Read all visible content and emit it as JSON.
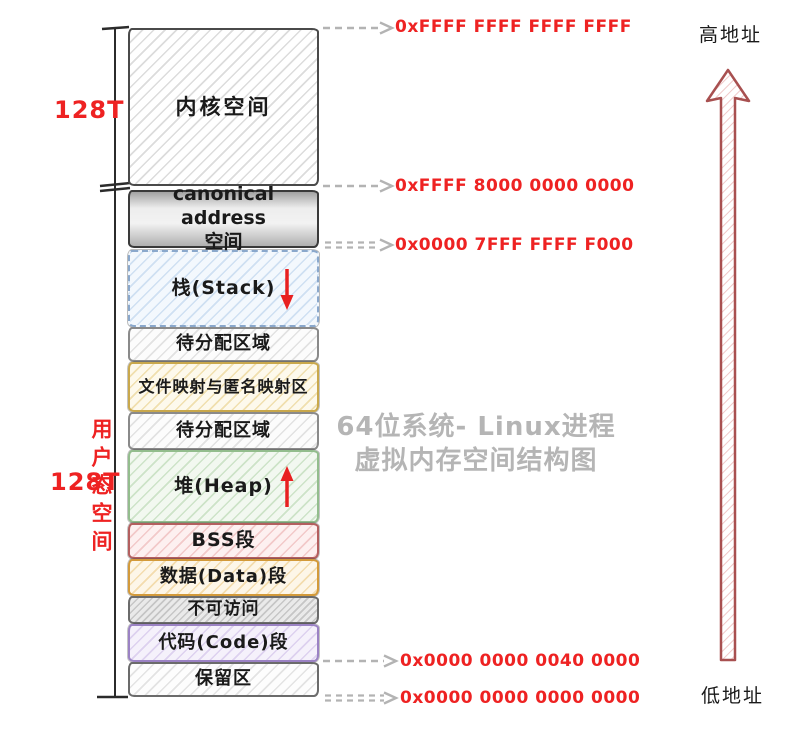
{
  "diagram_title": {
    "line1": "64位系统- Linux进程",
    "line2": "虚拟内存空间结构图"
  },
  "left_labels": {
    "kernel_size": "128T",
    "user_size": "128T",
    "user_space": "用户态空间"
  },
  "axis_labels": {
    "high": "高地址",
    "low": "低地址"
  },
  "addresses": {
    "top": "0xFFFF FFFF FFFF FFFF",
    "kernel_bottom": "0xFFFF 8000 0000 0000",
    "stack_top": "0x0000 7FFF FFFF F000",
    "code_start": "0x0000 0000 0040 0000",
    "zero": "0x0000 0000 0000 0000"
  },
  "colors": {
    "address_text": "#ee2222",
    "size_label_text": "#ee2222",
    "title_text": "#b5b5b5",
    "dashed_arrow": "#b3b3b3",
    "growth_arrow": "#e82020",
    "axis_arrow_stroke": "#a85050",
    "axis_arrow_hatch": "#eec2c2",
    "bracket_line": "#2b2b2b"
  },
  "segments": [
    {
      "name": "kernel-space",
      "label": "内核空间",
      "fill": "#ffffff",
      "hatch": "#dcdcdc",
      "border": "#4a4a4a"
    },
    {
      "name": "canonical-address",
      "label": "canonical address 空间",
      "line1": "canonical address",
      "line2": "空间",
      "fill": "#d9d9d9",
      "hatch": "transparent",
      "border": "#3a3a3a"
    },
    {
      "name": "stack",
      "label": "栈(Stack)",
      "growth": "down",
      "fill": "#f3f8fd",
      "hatch": "#cfe0f2",
      "border": "#8aa8cc"
    },
    {
      "name": "unallocated-upper",
      "label": "待分配区域",
      "fill": "#fcfcfc",
      "hatch": "#e2e2e2",
      "border": "#8a8a8a"
    },
    {
      "name": "file-mapping",
      "label": "文件映射与匿名映射区",
      "fill": "#fdf9ec",
      "hatch": "#f0dfae",
      "border": "#c9a84c"
    },
    {
      "name": "unallocated-lower",
      "label": "待分配区域",
      "fill": "#fcfcfc",
      "hatch": "#e2e2e2",
      "border": "#8a8a8a"
    },
    {
      "name": "heap",
      "label": "堆(Heap)",
      "growth": "up",
      "fill": "#f2f8f0",
      "hatch": "#cde3c8",
      "border": "#93bd8d"
    },
    {
      "name": "bss",
      "label": "BSS段",
      "fill": "#fdf0f0",
      "hatch": "#f2c9c9",
      "border": "#b45f5f"
    },
    {
      "name": "data",
      "label": "数据(Data)段",
      "fill": "#fdf6e8",
      "hatch": "#f3dcae",
      "border": "#d39a3a"
    },
    {
      "name": "inaccessible",
      "label": "不可访问",
      "fill": "#eaeaea",
      "hatch": "#c6c6c6",
      "border": "#6b6b6b"
    },
    {
      "name": "code",
      "label": "代码(Code)段",
      "fill": "#f5f1fb",
      "hatch": "#ddd1ef",
      "border": "#9b82c4"
    },
    {
      "name": "reserved",
      "label": "保留区",
      "fill": "#fdfdfd",
      "hatch": "#e3e3e3",
      "border": "#6b6b6b"
    }
  ]
}
